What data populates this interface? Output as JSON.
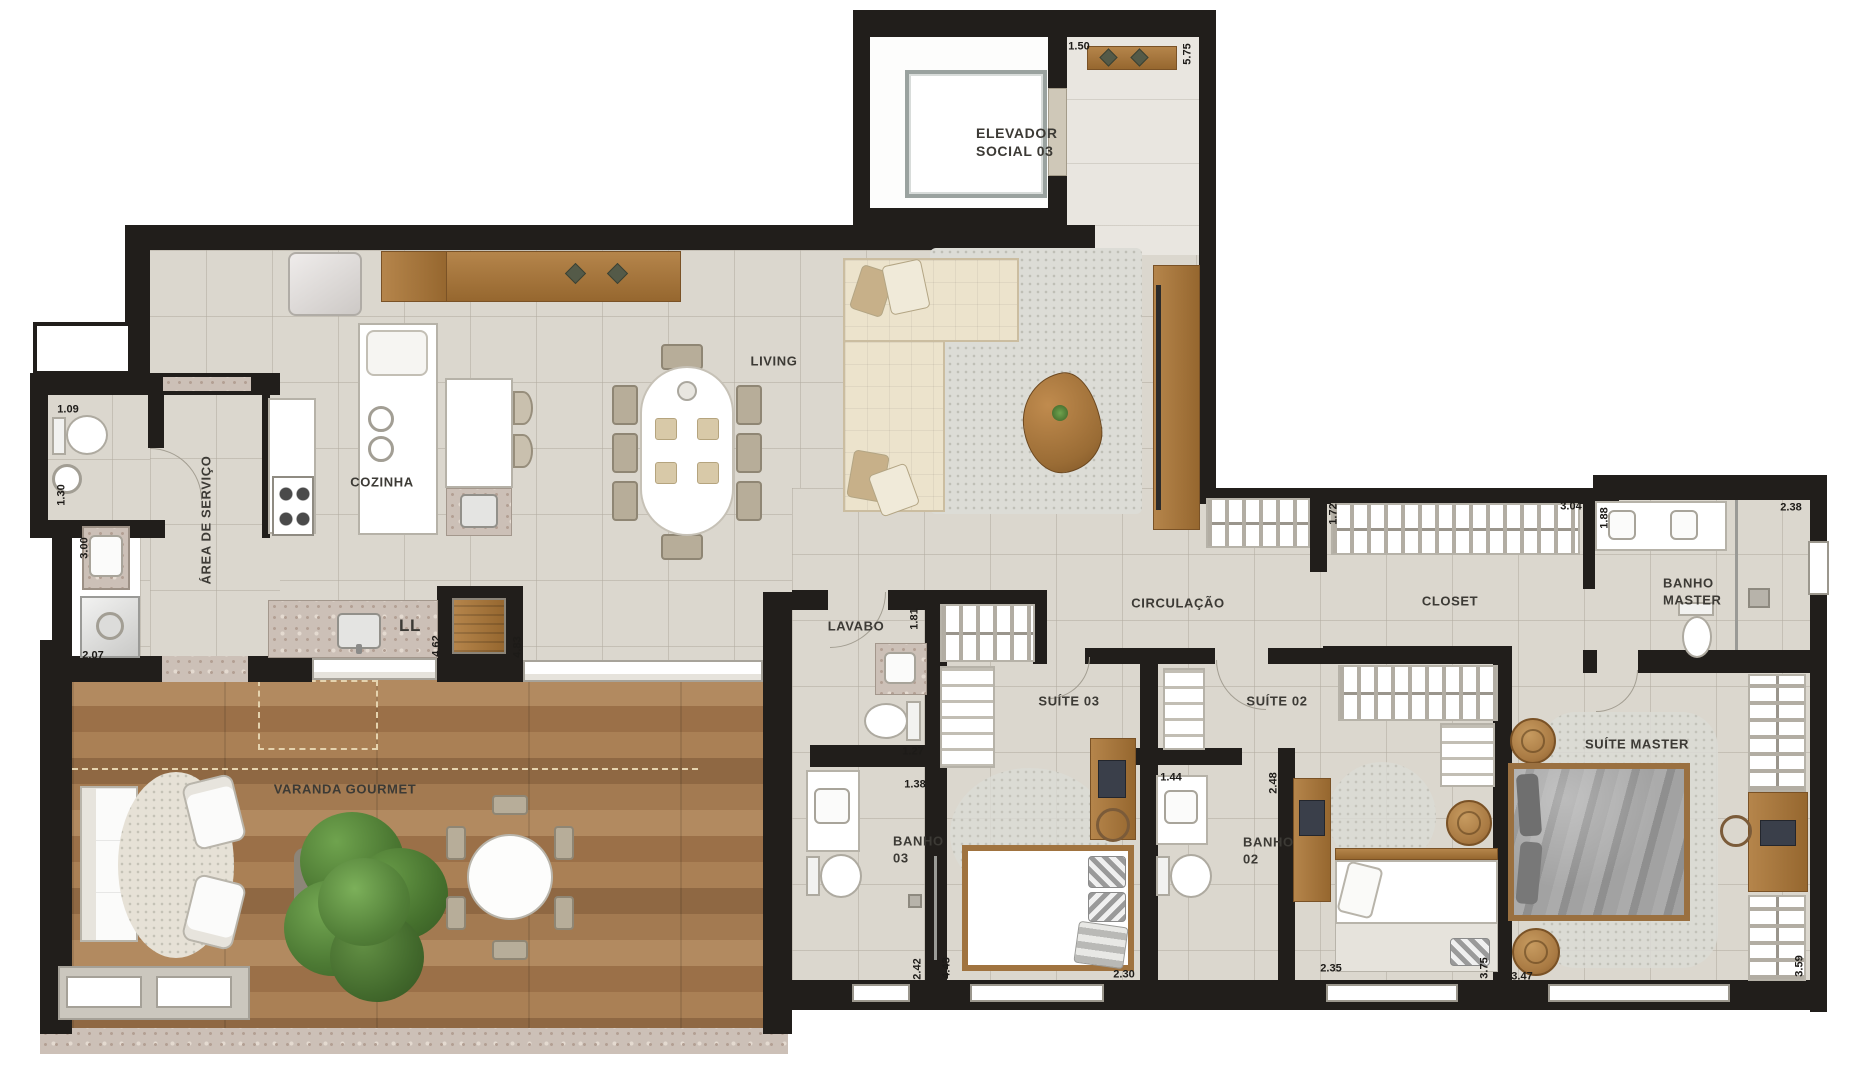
{
  "title": "Planta do apartamento",
  "rooms": {
    "elevador1": "ELEVADOR",
    "elevador2": "SOCIAL 03",
    "living": "LIVING",
    "cozinha": "COZINHA",
    "area_servico": "ÁREA DE SERVIÇO",
    "lavabo": "LAVABO",
    "circulacao": "CIRCULAÇÃO",
    "closet": "CLOSET",
    "banho_master1": "BANHO",
    "banho_master2": "MASTER",
    "suite03": "SUÍTE 03",
    "suite02": "SUÍTE 02",
    "suite_master": "SUÍTE MASTER",
    "banho03_1": "BANHO",
    "banho03_2": "03",
    "banho02_1": "BANHO",
    "banho02_2": "02",
    "varanda": "VARANDA GOURMET",
    "ll": "LL"
  },
  "dims": [
    "1.50",
    "5.75",
    "1.09",
    "1.30",
    "3.00",
    "2.07",
    "4.62",
    "4.83",
    "1.81",
    "1.27",
    "1.38",
    "2.42",
    "4.43",
    "2.30",
    "1.44",
    "2.48",
    "2.35",
    "3.75",
    "3.47",
    "3.59",
    "1.72",
    "3.04",
    "1.88",
    "2.38"
  ],
  "colors": {
    "wall": "#211e1b",
    "floor_tile": "#dbd7ce",
    "deck_wood": "#a57a50",
    "furniture_wood": "#a9773e",
    "granite": "#ccc0b7",
    "sofa_cream": "#ece3cc",
    "tree_green": "#4a7631"
  }
}
